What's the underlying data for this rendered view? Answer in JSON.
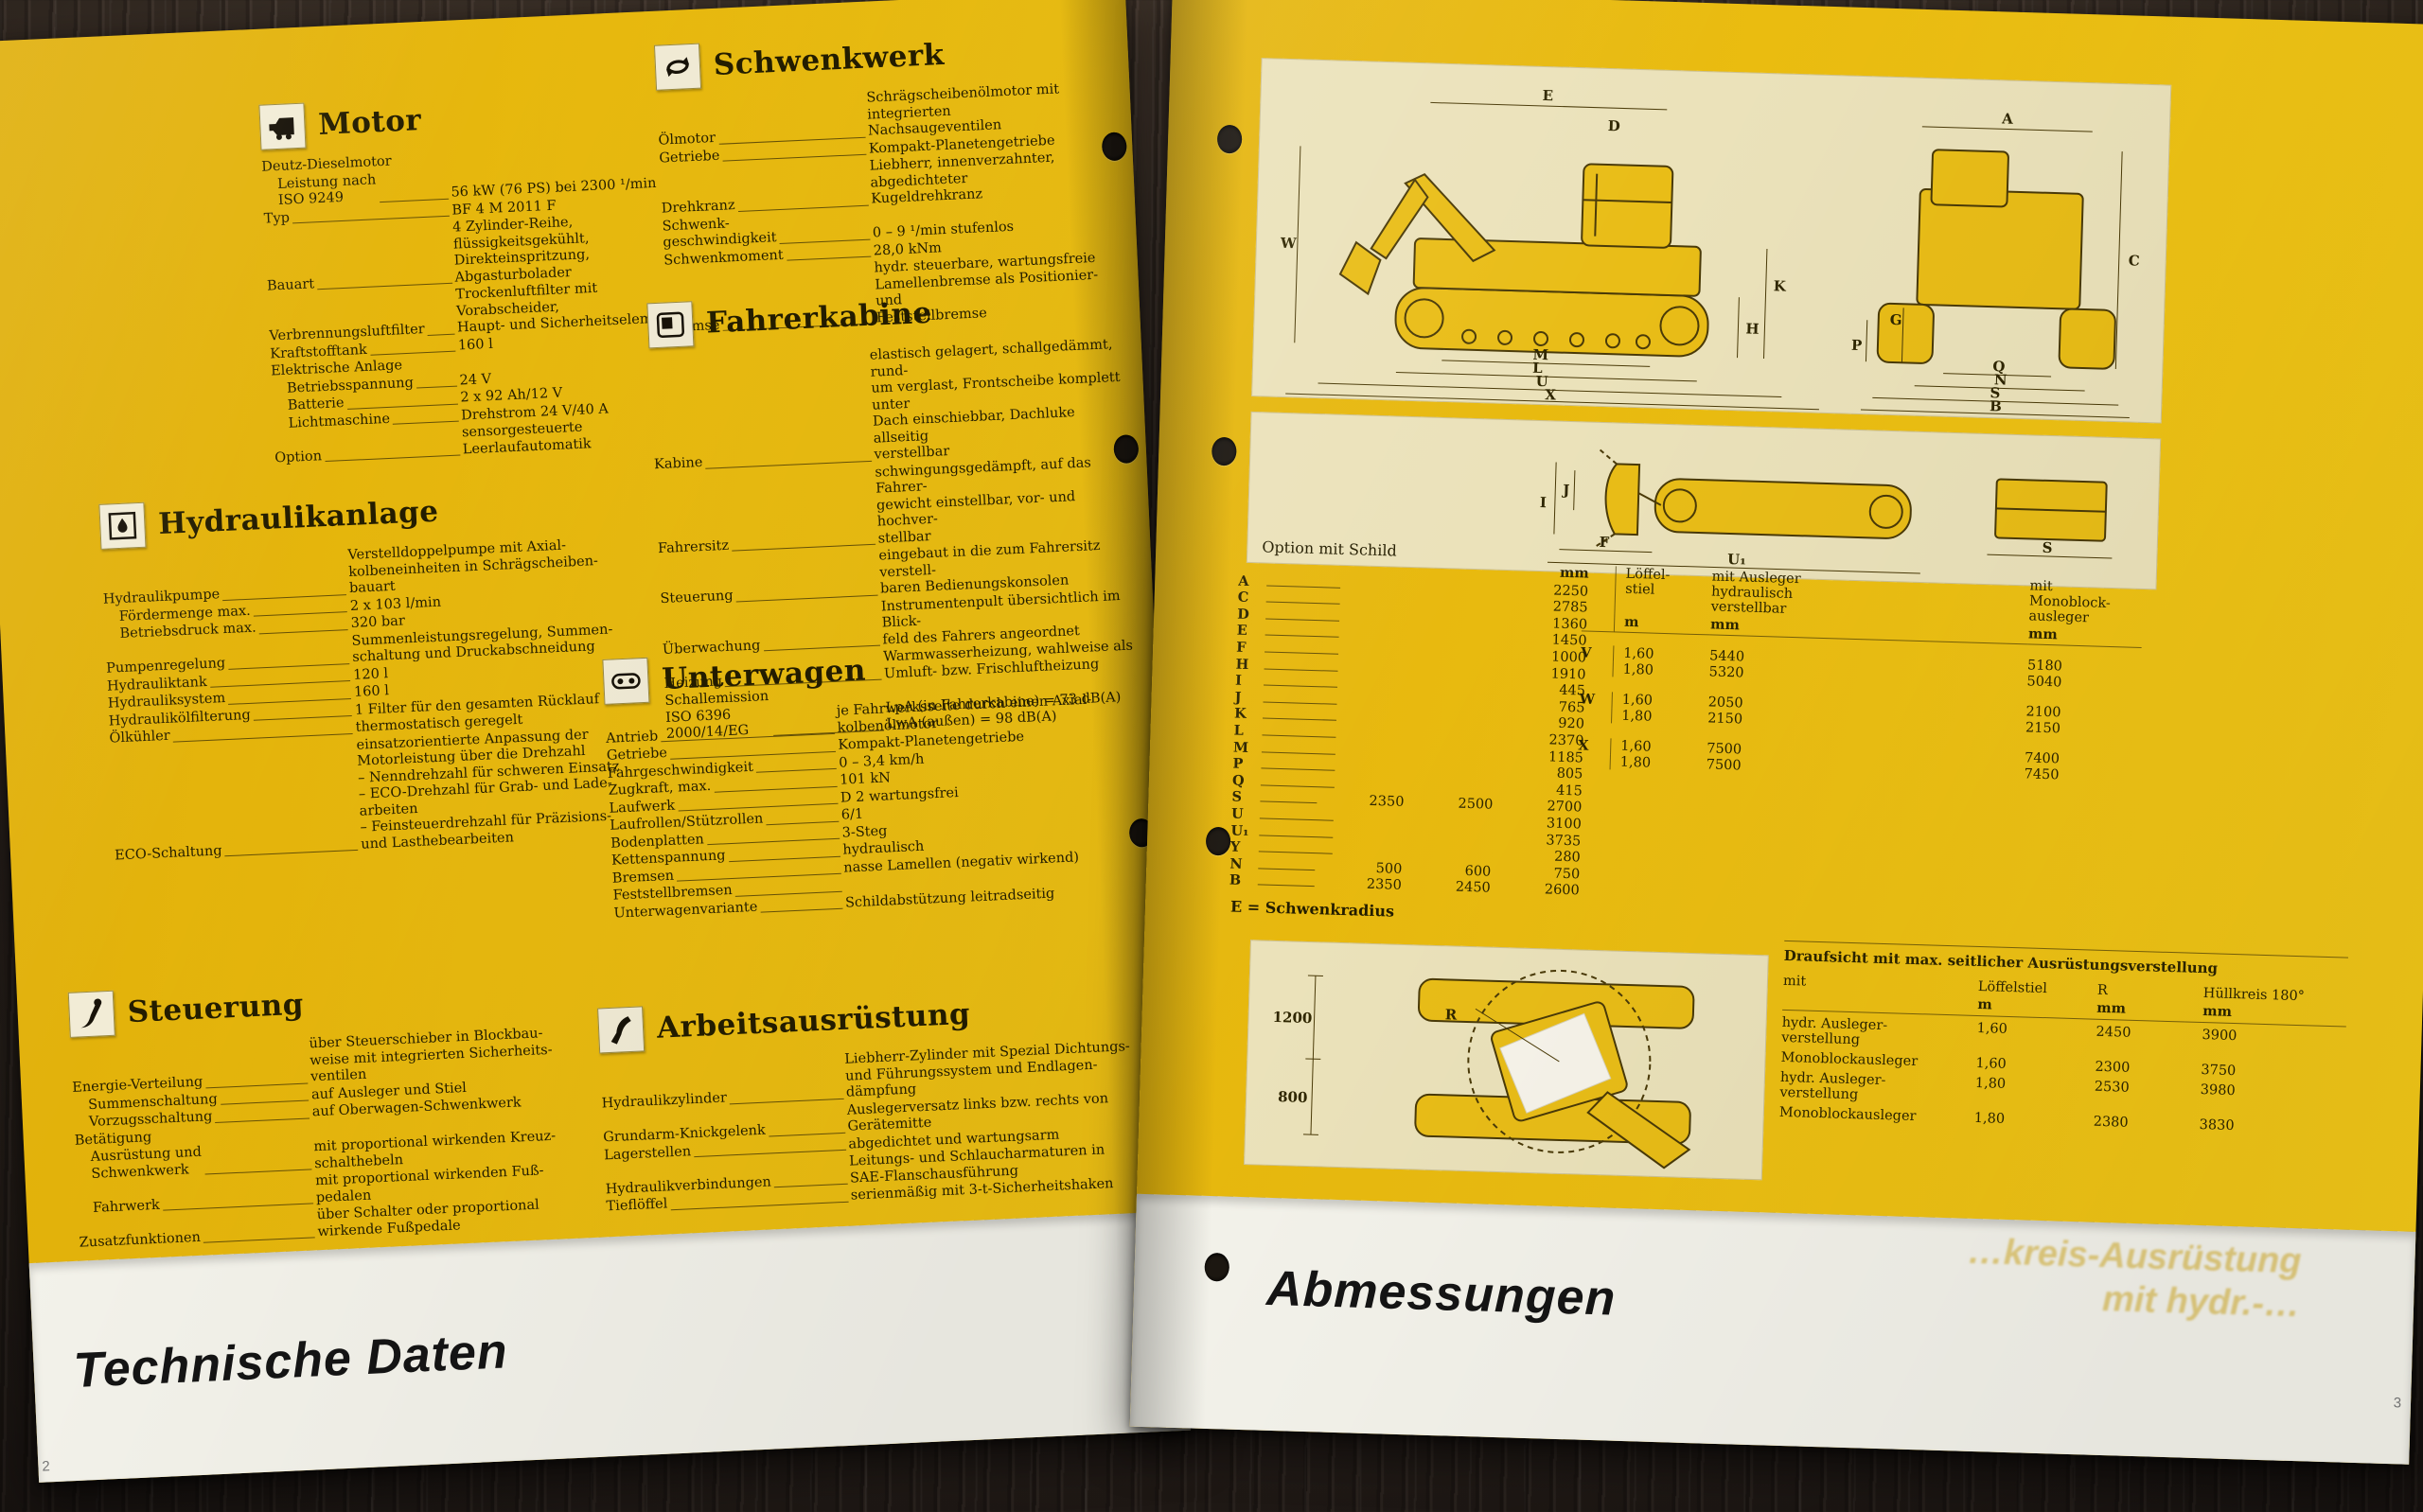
{
  "left_page": {
    "footer_title": "Technische Daten",
    "page_number": "2",
    "sections": [
      {
        "id": "motor",
        "title": "Motor",
        "icon": "engine-icon",
        "rows": [
          {
            "label": "Deutz-Dieselmotor",
            "value": "",
            "noline": true
          },
          {
            "label": "Leistung nach\nISO 9249",
            "value": "56 kW (76 PS) bei 2300 ¹/min",
            "indent": true
          },
          {
            "label": "Typ",
            "value": "BF 4 M 2011 F"
          },
          {
            "label": "Bauart",
            "value": "4 Zylinder-Reihe,\nflüssigkeitsgekühlt,\nDirekteinspritzung,\nAbgasturbolader"
          },
          {
            "label": "Verbrennungsluftfilter",
            "value": "Trockenluftfilter mit Vorabscheider,\nHaupt- und Sicherheitselement"
          },
          {
            "label": "Kraftstofftank",
            "value": "160 l"
          },
          {
            "label": "Elektrische Anlage",
            "value": "",
            "noline": true
          },
          {
            "label": "Betriebsspannung",
            "value": "24 V",
            "indent": true
          },
          {
            "label": "Batterie",
            "value": "2 x 92 Ah/12 V",
            "indent": true
          },
          {
            "label": "Lichtmaschine",
            "value": "Drehstrom 24 V/40 A",
            "indent": true
          },
          {
            "label": "Option",
            "value": "sensorgesteuerte Leerlaufautomatik"
          }
        ]
      },
      {
        "id": "hydraulikanlage",
        "title": "Hydraulikanlage",
        "icon": "hydraulic-pump-icon",
        "rows": [
          {
            "label": "Hydraulikpumpe",
            "value": "Verstelldoppelpumpe mit Axial-\nkolbeneinheiten in Schrägscheiben-\nbauart"
          },
          {
            "label": "Fördermenge max.",
            "value": "2 x 103 l/min",
            "indent": true
          },
          {
            "label": "Betriebsdruck max.",
            "value": "320 bar",
            "indent": true
          },
          {
            "label": "Pumpenregelung",
            "value": "Summenleistungsregelung, Summen-\nschaltung und Druckabschneidung"
          },
          {
            "label": "Hydrauliktank",
            "value": "120 l"
          },
          {
            "label": "Hydrauliksystem",
            "value": "160 l"
          },
          {
            "label": "Hydraulikölfilterung",
            "value": "1 Filter für den gesamten Rücklauf"
          },
          {
            "label": "Ölkühler",
            "value": "thermostatisch geregelt"
          },
          {
            "label": "ECO-Schaltung",
            "value": "einsatzorientierte Anpassung der\nMotorleistung über die Drehzahl\n– Nenndrehzahl für schweren Einsatz\n– ECO-Drehzahl für Grab- und Lade-\narbeiten\n– Feinsteuerdrehzahl für Präzisions-\nund Lasthebearbeiten"
          }
        ]
      },
      {
        "id": "steuerung",
        "title": "Steuerung",
        "icon": "control-lever-icon",
        "rows": [
          {
            "label": "Energie-Verteilung",
            "value": "über Steuerschieber in Blockbau-\nweise mit integrierten Sicherheits-\nventilen"
          },
          {
            "label": "Summenschaltung",
            "value": "auf Ausleger und Stiel",
            "indent": true
          },
          {
            "label": "Vorzugsschaltung",
            "value": "auf Oberwagen-Schwenkwerk",
            "indent": true
          },
          {
            "label": "Betätigung",
            "value": "",
            "noline": true
          },
          {
            "label": "Ausrüstung und\nSchwenkwerk",
            "value": "mit proportional wirkenden Kreuz-\nschalthebeln",
            "indent": true
          },
          {
            "label": "Fahrwerk",
            "value": "mit proportional wirkenden Fuß-\npedalen",
            "indent": true
          },
          {
            "label": "Zusatzfunktionen",
            "value": "über Schalter oder proportional\nwirkende Fußpedale"
          }
        ]
      },
      {
        "id": "schwenkwerk",
        "title": "Schwenkwerk",
        "icon": "swing-arrows-icon",
        "rows": [
          {
            "label": "Ölmotor",
            "value": "Schrägscheibenölmotor mit integrierten\nNachsaugeventilen"
          },
          {
            "label": "Getriebe",
            "value": "Kompakt-Planetengetriebe"
          },
          {
            "label": "Drehkranz",
            "value": "Liebherr, innenverzahnter, abgedichteter\nKugeldrehkranz"
          },
          {
            "label": "Schwenk-\ngeschwindigkeit",
            "value": "0 – 9 ¹/min stufenlos"
          },
          {
            "label": "Schwenkmoment",
            "value": "28,0 kNm"
          },
          {
            "label": "Bremse",
            "value": "hydr. steuerbare, wartungsfreie\nLamellenbremse als Positionier- und\nFeststellbremse"
          }
        ]
      },
      {
        "id": "fahrerkabine",
        "title": "Fahrerkabine",
        "icon": "cab-icon",
        "rows": [
          {
            "label": "Kabine",
            "value": "elastisch gelagert, schallgedämmt, rund-\num verglast, Frontscheibe komplett unter\nDach einschiebbar, Dachluke allseitig\nverstellbar"
          },
          {
            "label": "Fahrersitz",
            "value": "schwingungsgedämpft, auf das Fahrer-\ngewicht einstellbar, vor- und hochver-\nstellbar"
          },
          {
            "label": "Steuerung",
            "value": "eingebaut in die zum Fahrersitz verstell-\nbaren Bedienungskonsolen"
          },
          {
            "label": "Überwachung",
            "value": "Instrumentenpult übersichtlich im Blick-\nfeld des Fahrers angeordnet"
          },
          {
            "label": "Heizung",
            "value": "Warmwasserheizung, wahlweise als\nUmluft- bzw. Frischluftheizung"
          },
          {
            "label": "Schallemission\nISO 6396\n2000/14/EG",
            "value": "LpA (in Fahrerkabine) = 73 dB(A)\nLwA (außen)              = 98 dB(A)"
          }
        ]
      },
      {
        "id": "unterwagen",
        "title": "Unterwagen",
        "icon": "track-link-icon",
        "rows": [
          {
            "label": "Antrieb",
            "value": "je Fahrwerksseite durch einen Axial-\nkolbenölmotor"
          },
          {
            "label": "Getriebe",
            "value": "Kompakt-Planetengetriebe"
          },
          {
            "label": "Fahrgeschwindigkeit",
            "value": "0 – 3,4 km/h"
          },
          {
            "label": "Zugkraft, max.",
            "value": "101 kN"
          },
          {
            "label": "Laufwerk",
            "value": "D 2 wartungsfrei"
          },
          {
            "label": "Laufrollen/Stützrollen",
            "value": "6/1"
          },
          {
            "label": "Bodenplatten",
            "value": "3-Steg"
          },
          {
            "label": "Kettenspannung",
            "value": "hydraulisch"
          },
          {
            "label": "Bremsen",
            "value": "nasse Lamellen (negativ wirkend)"
          },
          {
            "label": "Feststellbremsen",
            "value": ""
          },
          {
            "label": "Unterwagenvariante",
            "value": "Schildabstützung leitradseitig"
          }
        ]
      },
      {
        "id": "arbeitsausruestung",
        "title": "Arbeitsausrüstung",
        "icon": "boom-icon",
        "rows": [
          {
            "label": "Hydraulikzylinder",
            "value": "Liebherr-Zylinder mit Spezial Dichtungs-\nund Führungssystem und Endlagen-\ndämpfung"
          },
          {
            "label": "Grundarm-Knickgelenk",
            "value": "Auslegerversatz links bzw. rechts von\nGerätemitte"
          },
          {
            "label": "Lagerstellen",
            "value": "abgedichtet und wartungsarm"
          },
          {
            "label": "Hydraulikverbindungen",
            "value": "Leitungs- und Schlaucharmaturen in\nSAE-Flanschausführung"
          },
          {
            "label": "Tieflöffel",
            "value": "serienmäßig mit 3-t-Sicherheitshaken"
          }
        ]
      }
    ]
  },
  "right_page": {
    "footer_title": "Abmessungen",
    "page_number": "3",
    "option_caption": "Option mit Schild",
    "note": "E = Schwenkradius",
    "showthrough_line1": "…kreis-Ausrüstung",
    "showthrough_line2": "mit hydr.-…",
    "dim_table": {
      "unit_header": "mm",
      "rows": [
        {
          "letter": "A",
          "values": [
            "2250"
          ]
        },
        {
          "letter": "C",
          "values": [
            "2785"
          ]
        },
        {
          "letter": "D",
          "values": [
            "1360"
          ]
        },
        {
          "letter": "E",
          "values": [
            "1450"
          ]
        },
        {
          "letter": "F",
          "values": [
            "1000"
          ]
        },
        {
          "letter": "H",
          "values": [
            "1910"
          ]
        },
        {
          "letter": "I",
          "values": [
            "445"
          ]
        },
        {
          "letter": "J",
          "values": [
            "765"
          ]
        },
        {
          "letter": "K",
          "values": [
            "920"
          ]
        },
        {
          "letter": "L",
          "values": [
            "2370"
          ]
        },
        {
          "letter": "M",
          "values": [
            "1185"
          ]
        },
        {
          "letter": "P",
          "values": [
            "805"
          ]
        },
        {
          "letter": "Q",
          "values": [
            "415"
          ]
        },
        {
          "letter": "S",
          "values": [
            "2350",
            "2500",
            "2700"
          ]
        },
        {
          "letter": "U",
          "values": [
            "3100"
          ]
        },
        {
          "letter": "U₁",
          "values": [
            "3735"
          ]
        },
        {
          "letter": "Y",
          "values": [
            "280"
          ]
        },
        {
          "letter": "N",
          "values": [
            "500",
            "600",
            "750"
          ]
        },
        {
          "letter": "B",
          "values": [
            "2350",
            "2450",
            "2600"
          ]
        }
      ]
    },
    "vwx_table": {
      "col_headers": [
        "Löffel-\nstiel",
        "mit Ausleger\nhydraulisch\nverstellbar",
        "mit\nMonoblock-\nausleger"
      ],
      "col_units": [
        "m",
        "mm",
        "mm"
      ],
      "groups": [
        {
          "letter": "V",
          "rows": [
            [
              "1,60",
              "5440",
              "5180"
            ],
            [
              "1,80",
              "5320",
              "5040"
            ]
          ]
        },
        {
          "letter": "W",
          "rows": [
            [
              "1,60",
              "2050",
              "2100"
            ],
            [
              "1,80",
              "2150",
              "2150"
            ]
          ]
        },
        {
          "letter": "X",
          "rows": [
            [
              "1,60",
              "7500",
              "7400"
            ],
            [
              "1,80",
              "7500",
              "7450"
            ]
          ]
        }
      ]
    },
    "topview_table": {
      "title": "Draufsicht mit max. seitlicher Ausrüstungsverstellung",
      "col_headers": [
        "mit",
        "Löffelstiel",
        "R",
        "Hüllkreis 180°"
      ],
      "col_units": [
        "",
        "m",
        "mm",
        "mm"
      ],
      "rows": [
        {
          "label": "hydr. Ausleger-\nverstellung",
          "stiel": "1,60",
          "r": "2450",
          "huellkreis": "3900"
        },
        {
          "label": "Monoblockausleger",
          "stiel": "1,60",
          "r": "2300",
          "huellkreis": "3750"
        },
        {
          "label": "hydr. Ausleger-\nverstellung",
          "stiel": "1,80",
          "r": "2530",
          "huellkreis": "3980"
        },
        {
          "label": "Monoblockausleger",
          "stiel": "1,80",
          "r": "2380",
          "huellkreis": "3830"
        }
      ]
    },
    "diagram_labels": {
      "main_view": [
        "E",
        "D",
        "W",
        "H",
        "K",
        "M",
        "L",
        "U",
        "X",
        "A",
        "C",
        "G",
        "P",
        "Q",
        "N",
        "S",
        "B"
      ],
      "blade_view": [
        "J",
        "I",
        "F",
        "U₁",
        "S"
      ],
      "top_view": [
        "1200",
        "800",
        "R"
      ]
    }
  }
}
